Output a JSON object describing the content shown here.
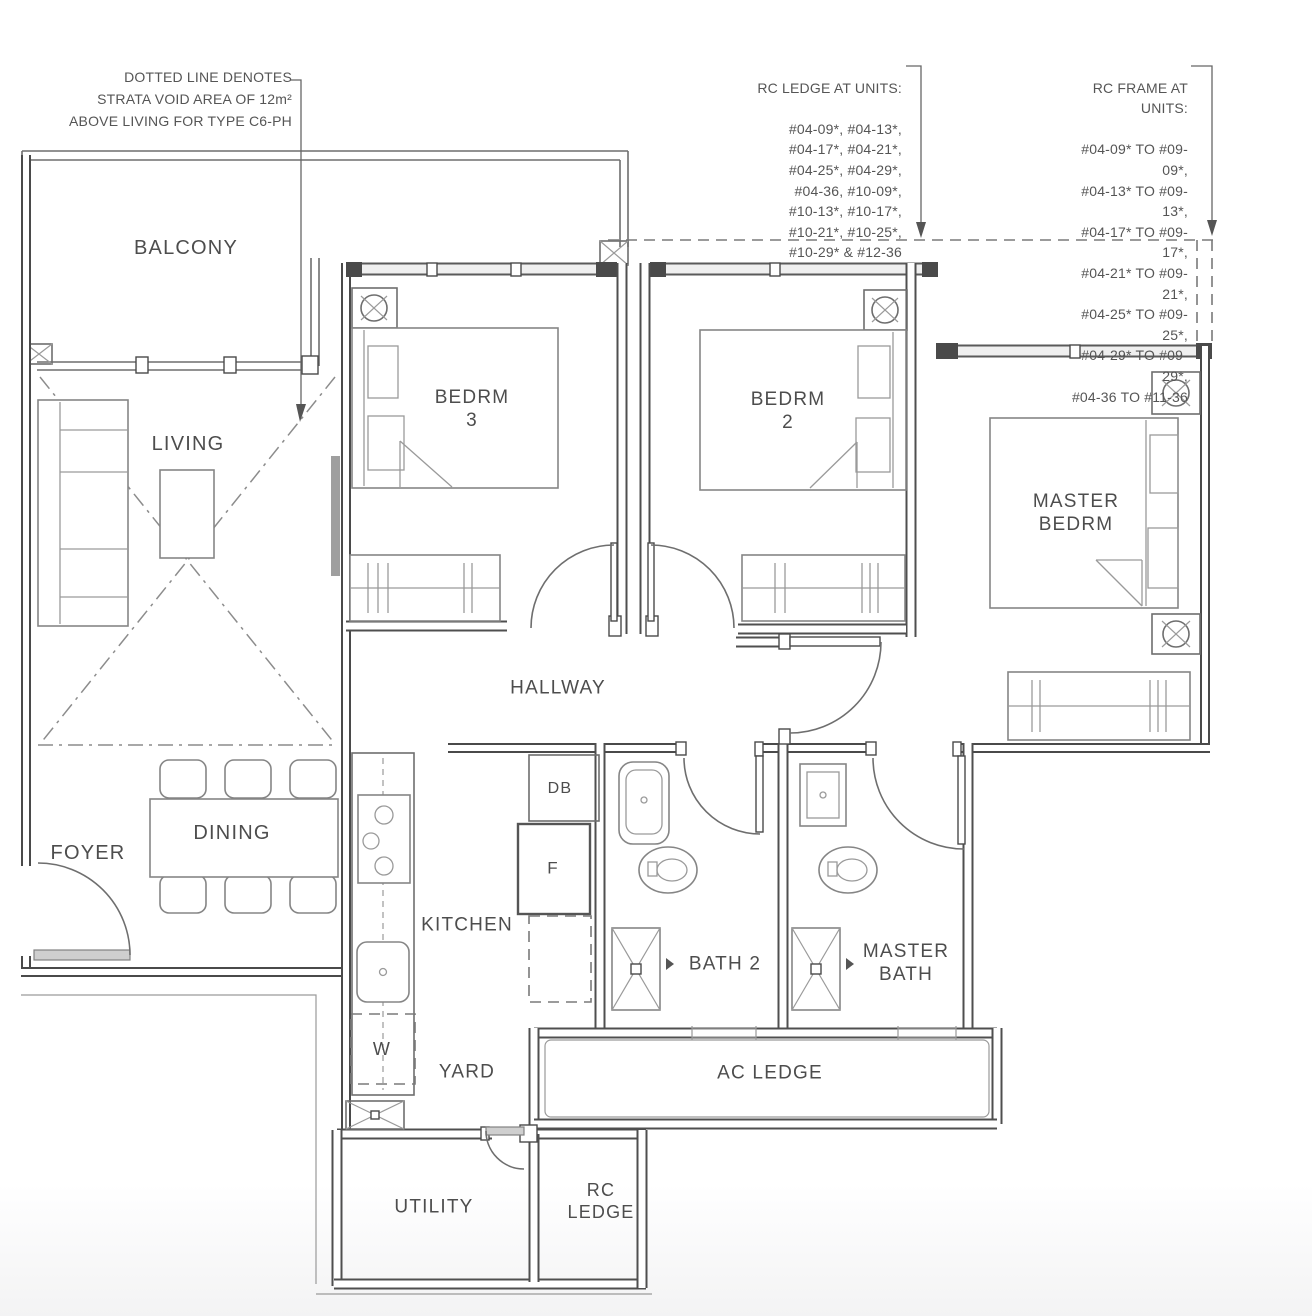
{
  "annotations": {
    "strata_void": "DOTTED LINE DENOTES\nSTRATA VOID AREA OF 12m²\nABOVE LIVING FOR TYPE C6-PH",
    "rc_ledge_title": "RC LEDGE AT UNITS:",
    "rc_ledge_units": "#04-09*, #04-13*,\n#04-17*, #04-21*,\n#04-25*, #04-29*,\n#04-36, #10-09*,\n#10-13*, #10-17*,\n#10-21*, #10-25*,\n#10-29* & #12-36",
    "rc_frame_title": "RC FRAME AT UNITS:",
    "rc_frame_units": "#04-09* TO #09-09*,\n#04-13* TO #09-13*,\n#04-17* TO #09-17*,\n#04-21* TO #09-21*,\n#04-25* TO #09-25*,\n#04-29* TO #09-29*,\n#04-36 TO #11-36"
  },
  "rooms": {
    "balcony": "BALCONY",
    "living": "LIVING",
    "bedrm3": "BEDRM\n3",
    "bedrm2": "BEDRM\n2",
    "master_bedrm": "MASTER\nBEDRM",
    "hallway": "HALLWAY",
    "foyer": "FOYER",
    "dining": "DINING",
    "kitchen": "KITCHEN",
    "yard": "YARD",
    "bath2": "BATH 2",
    "master_bath": "MASTER\nBATH",
    "ac_ledge": "AC LEDGE",
    "utility": "UTILITY",
    "rc_ledge": "RC\nLEDGE"
  },
  "appliances": {
    "db": "DB",
    "fridge": "F",
    "washer": "W"
  },
  "colors": {
    "wall": "#4a4a4a",
    "furniture_line": "#858585",
    "text": "#4d4d4d",
    "background": "#ffffff"
  }
}
